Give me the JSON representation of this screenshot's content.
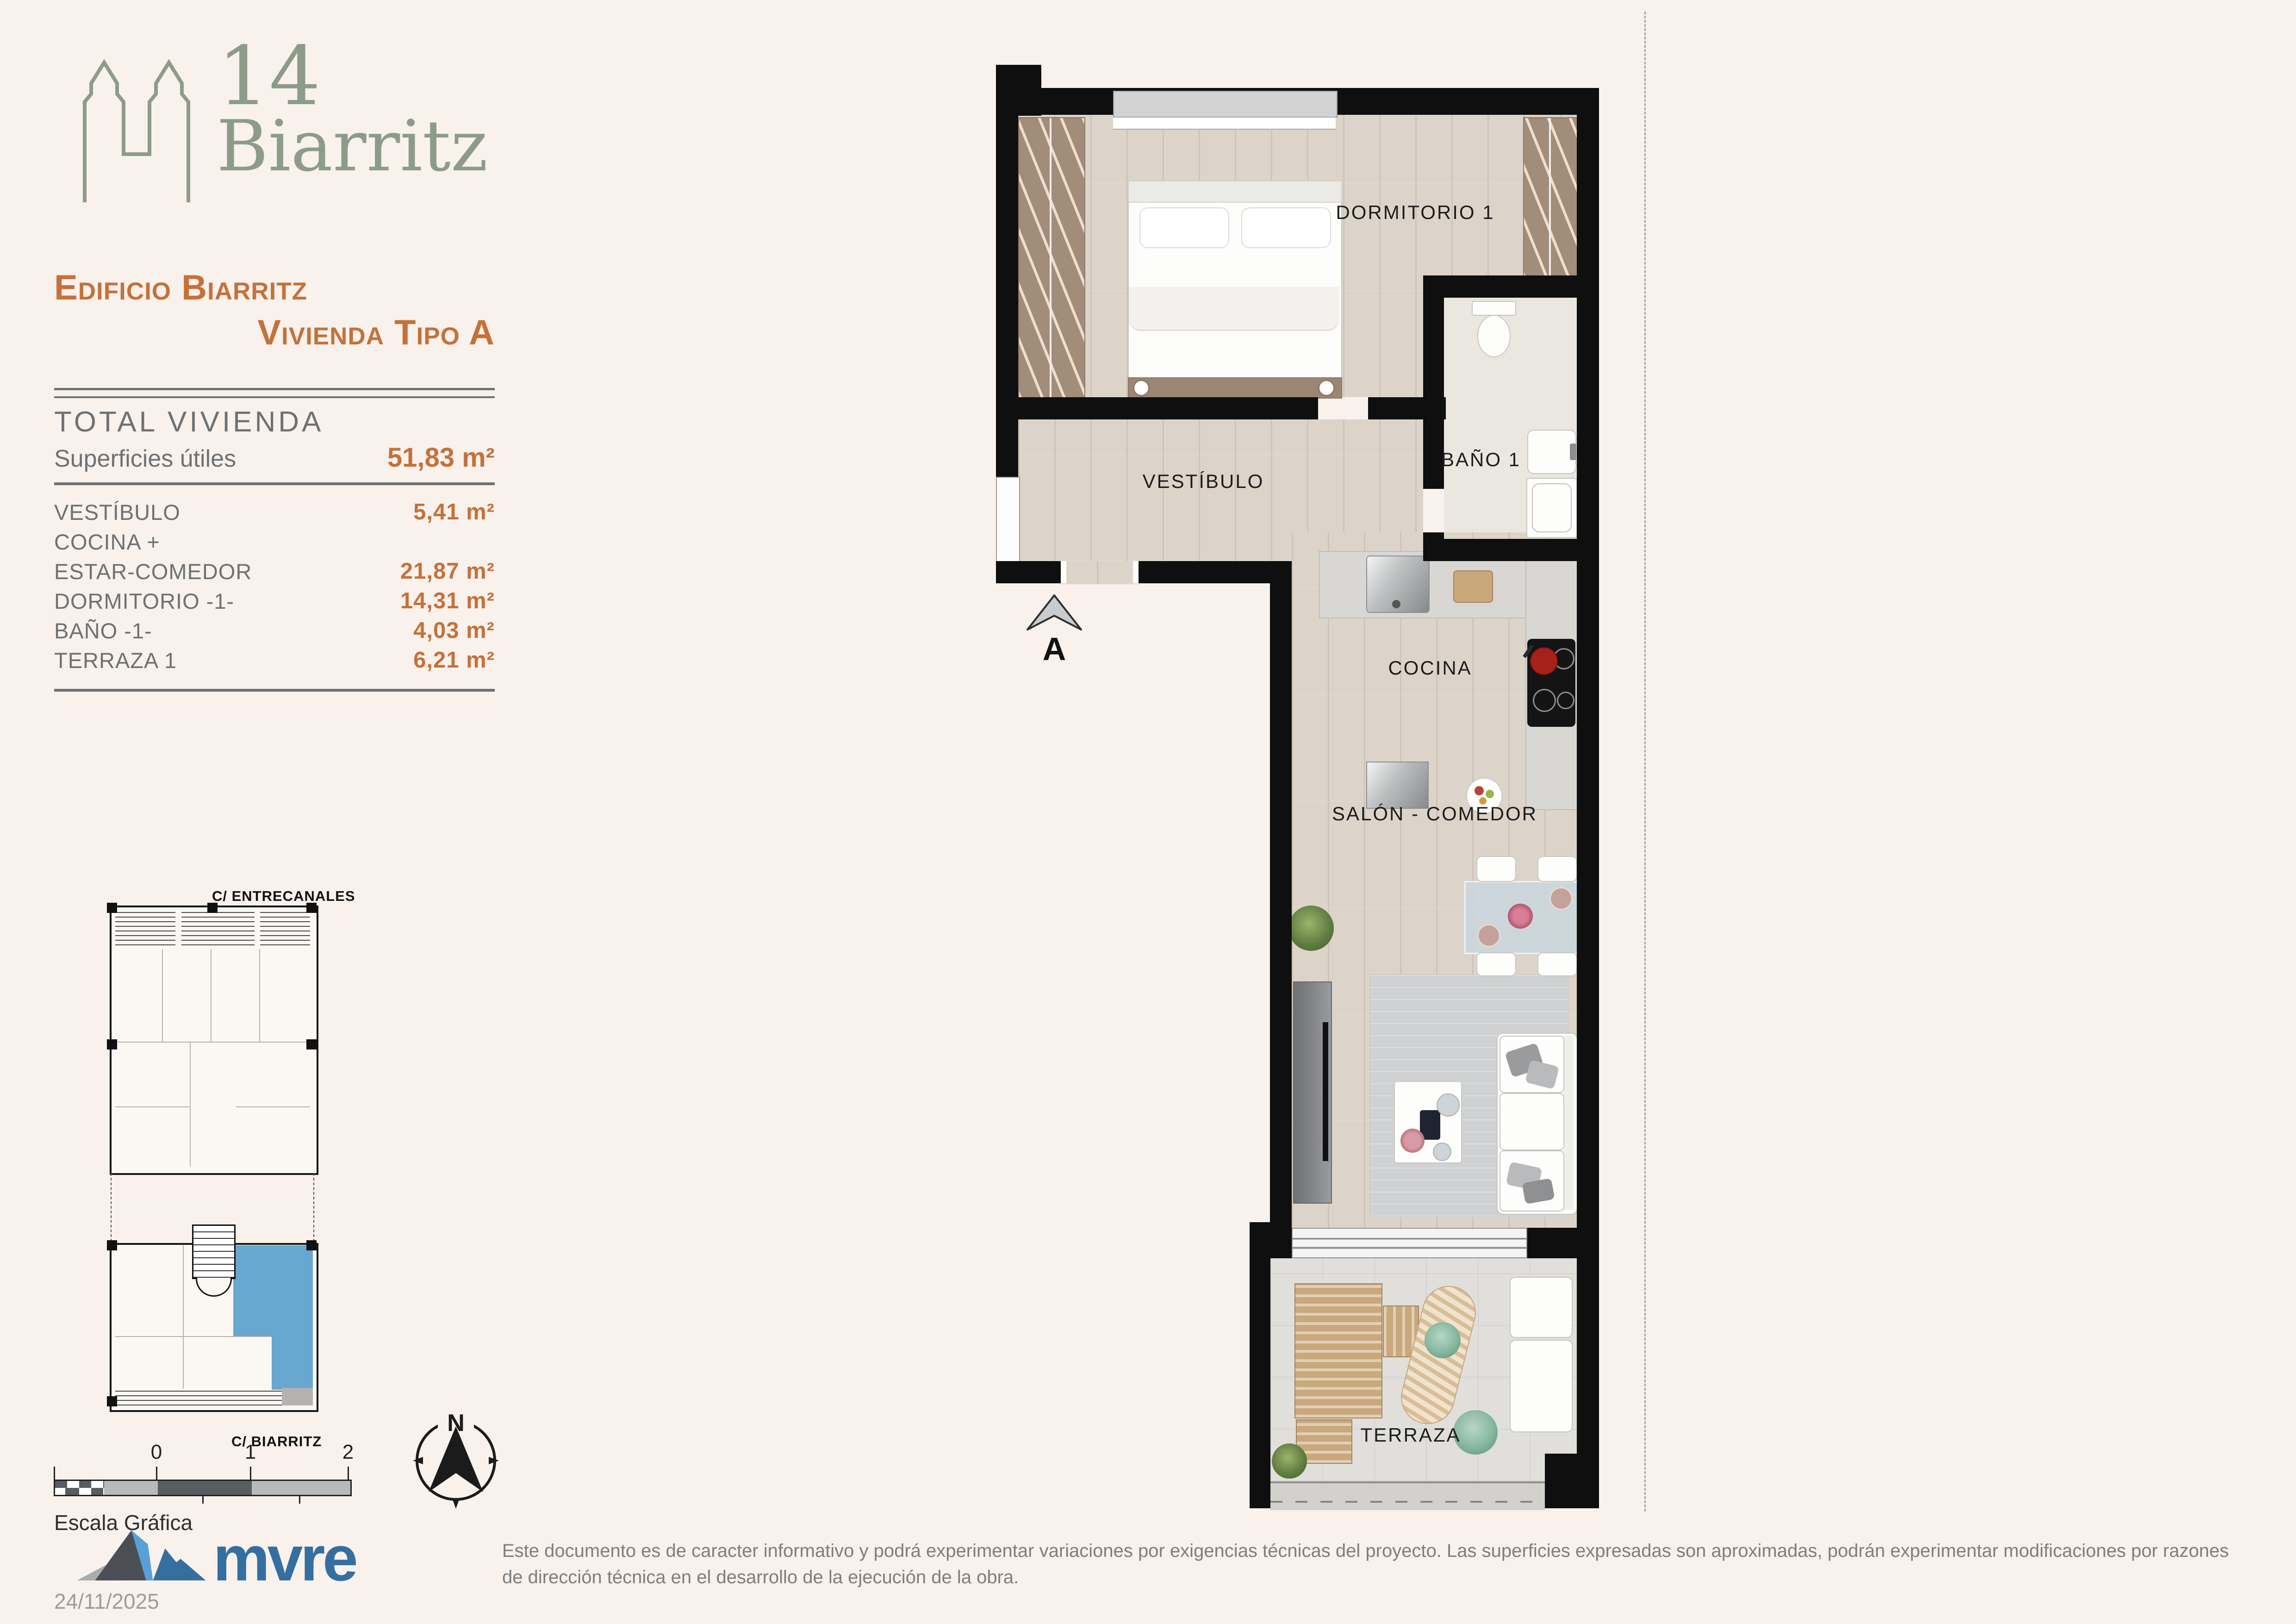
{
  "brand": {
    "number": "14",
    "name": "Biarritz",
    "color": "#8d9c89"
  },
  "heading": {
    "line1": "Edificio Biarritz",
    "line2": "Vivienda Tipo A",
    "color": "#c4713a"
  },
  "areas_table": {
    "title": "TOTAL VIVIENDA",
    "subtitle": "Superficies útiles",
    "total_value": "51,83 m²",
    "rows": [
      {
        "label": "VESTÍBULO",
        "value": "5,41 m²"
      },
      {
        "label": "COCINA +",
        "value": ""
      },
      {
        "label": "ESTAR-COMEDOR",
        "value": "21,87 m²"
      },
      {
        "label": "DORMITORIO -1-",
        "value": "14,31 m²"
      },
      {
        "label": "BAÑO -1-",
        "value": "4,03 m²"
      },
      {
        "label": "TERRAZA 1",
        "value": "6,21 m²"
      }
    ]
  },
  "floor_plan": {
    "room_labels": {
      "bedroom": "DORMITORIO 1",
      "bath": "BAÑO 1",
      "hall": "VESTÍBULO",
      "kitchen": "COCINA",
      "living": "SALÓN - COMEDOR",
      "terrace": "TERRAZA"
    },
    "entrance_marker": "A"
  },
  "site_plan": {
    "street_top": "C/ ENTRECANALES",
    "street_bottom": "C/ BIARRITZ",
    "highlight_color": "#68a7cf"
  },
  "scale_bar": {
    "labels": [
      "0",
      "1",
      "2"
    ],
    "caption": "Escala Gráfica"
  },
  "compass": {
    "north_label": "N"
  },
  "footer": {
    "logo_text": "mvre",
    "logo_color": "#356f9f",
    "date": "24/11/2025",
    "disclaimer": "Este documento es de caracter informativo y podrá experimentar variaciones por exigencias técnicas del proyecto. Las superficies expresadas son aproximadas, podrán experimentar modificaciones por razones de dirección técnica en el desarrollo de la ejecución de la obra."
  }
}
